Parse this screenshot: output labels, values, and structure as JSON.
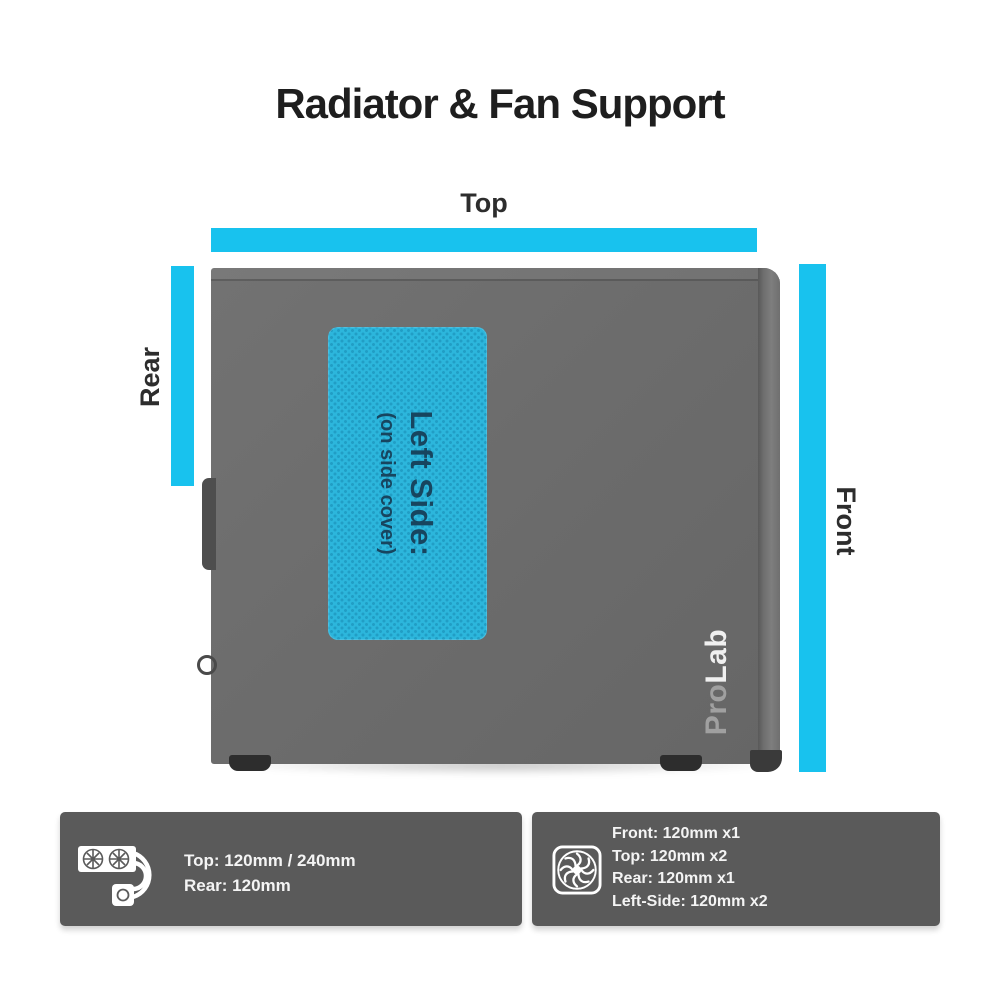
{
  "title": "Radiator & Fan Support",
  "colors": {
    "accent_cyan": "#18c2ee",
    "mesh_panel_cyan": "#2cb6dc",
    "case_gray": "#6c6c6c",
    "info_panel_gray": "#5a5a5a",
    "mesh_text_navy": "#17455f"
  },
  "diagram": {
    "top_label": "Top",
    "rear_label": "Rear",
    "front_label": "Front",
    "side_panel": {
      "line1": "Left Side:",
      "line2": "(on side cover)"
    },
    "logo": {
      "part1": "Pro",
      "part2": "Lab"
    }
  },
  "info": {
    "radiator": {
      "icon": "aio-radiator",
      "lines": [
        "Top: 120mm / 240mm",
        "Rear: 120mm"
      ]
    },
    "fan": {
      "icon": "case-fan",
      "lines": [
        "Front: 120mm x1",
        "Top: 120mm x2",
        "Rear: 120mm x1",
        "Left-Side: 120mm x2"
      ]
    }
  }
}
